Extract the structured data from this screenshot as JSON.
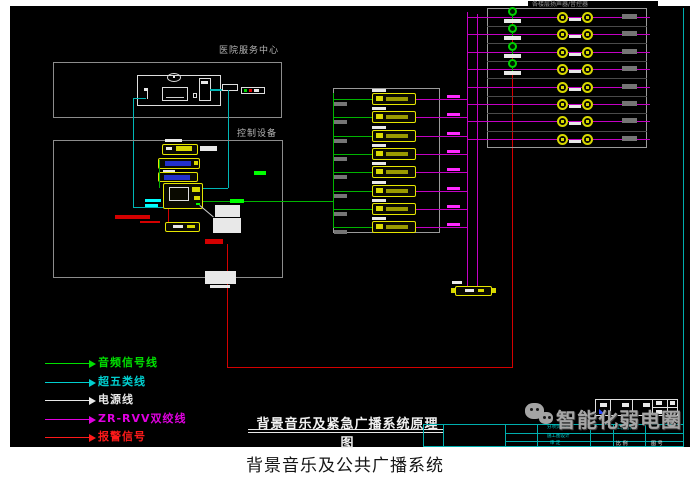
{
  "canvas": {
    "caption": "背景音乐及公共广播系统"
  },
  "labels": {
    "service_center": "医院服务中心",
    "control_equipment": "控制设备",
    "speaker_zone": "各楼层扬声器/音控器"
  },
  "title": {
    "text": "背景音乐及紧急广播系统原理图"
  },
  "watermark": {
    "text": "智能化弱电圈",
    "icon": "wechat-icon"
  },
  "legend": {
    "items": [
      {
        "label": "音频信号线",
        "color": "#00e000"
      },
      {
        "label": "超五类线",
        "color": "#00cfcf"
      },
      {
        "label": "电源线",
        "color": "#e8e8e8"
      },
      {
        "label": "ZR-RVV双绞线",
        "color": "#e000e0"
      },
      {
        "label": "报警信号",
        "color": "#ff1a1a"
      }
    ]
  },
  "titleblock": {
    "fields": [
      {
        "label": "分项负责人"
      },
      {
        "label": "施工图设计"
      },
      {
        "label": "审 定"
      },
      {
        "label": "工程名称"
      },
      {
        "label": "比 例"
      },
      {
        "label": "图 号"
      }
    ]
  },
  "diagram": {
    "amplifier_rows": 8,
    "speaker_rows": 8,
    "volume_control_rows": 4,
    "wire_colors": {
      "audio": "#00b400",
      "cat5e": "#00b6b6",
      "power": "#e0e0e0",
      "zr_rvv": "#c400c4",
      "alarm": "#d40000"
    }
  }
}
